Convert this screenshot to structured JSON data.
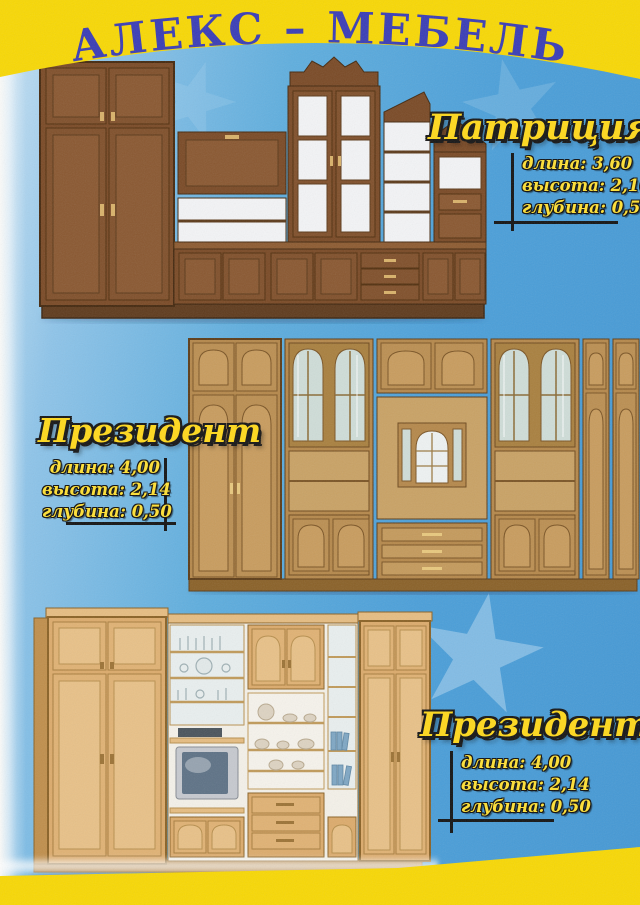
{
  "header": {
    "brand_title": "АЛЕКС – МЕБЕЛЬ"
  },
  "products": [
    {
      "name": "Патриция",
      "photo": "dark-walnut-wall-unit-photo",
      "specs": [
        "длина: 3,60",
        "высота: 2,16",
        "глубина: 0,50"
      ]
    },
    {
      "name": "Президент",
      "photo": "golden-oak-wall-unit-photo",
      "specs": [
        "длина: 4,00",
        "высота: 2,14",
        "глубина: 0,50"
      ]
    },
    {
      "name": "Президент-2",
      "photo": "light-oak-wall-unit-with-tv-photo",
      "specs": [
        "длина: 4,00",
        "высота: 2,14",
        "глубина: 0,50"
      ]
    }
  ],
  "colors": {
    "band_yellow": "#f8d805",
    "brand_title_blue": "#3a3db6",
    "background_blue": "#4b9fd9",
    "accent_text_yellow": "#ffe135",
    "outline_black": "#141414"
  }
}
